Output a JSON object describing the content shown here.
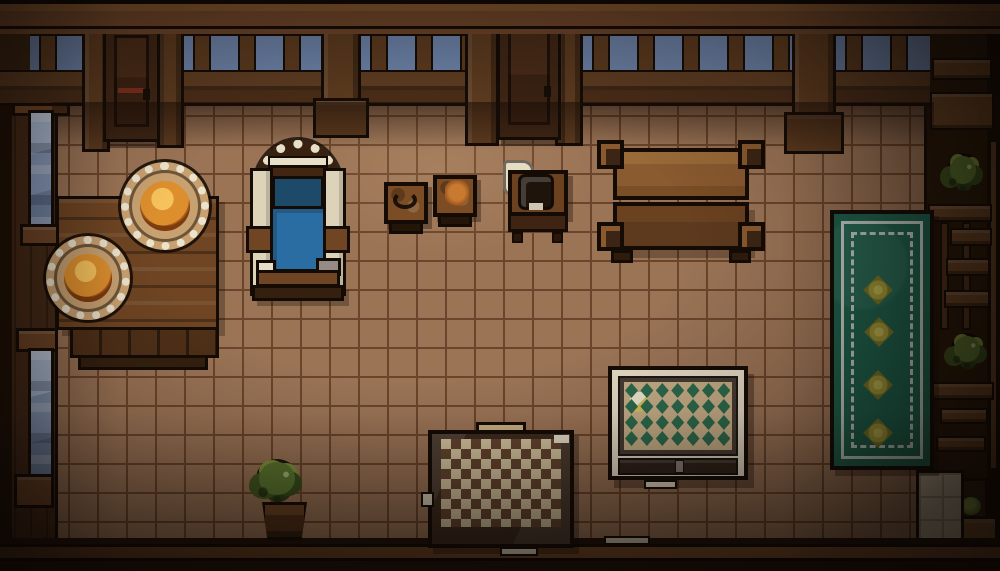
{
  "scene": {
    "title": "Top-down pixel-art tavern room",
    "style": "16-bit interior, warm lighting, dark vignette"
  },
  "palette": {
    "outline": "#140b05",
    "floor": "#9b7456",
    "floorGrout": "#6b452b",
    "wallDark": "#3a2412",
    "beam": "#70472a",
    "beamLight": "#83552e",
    "sky": "#6e85ac",
    "railLight": "#5f3d22",
    "railDark": "#4a2d18",
    "post": "#5d3b1f",
    "door": "#3f2615",
    "leftWall": "#452a17",
    "window": "#8b9fc0",
    "windowLight": "#aebfd8",
    "sill": "#6f4526",
    "rightWall": "#281808",
    "shelfWood": "#6b4423",
    "lightTiles": "#cfc2a8",
    "lightTileGrout": "#a89a82",
    "tableWood": "#6f4523",
    "tableWoodDark": "#4f3018",
    "plate": "#ece3cd",
    "plateInner": "#c8a171",
    "food": "#dd8f2e",
    "foodLight": "#f5c25c",
    "foodDark": "#a85a18",
    "bedCream": "#ddd3b8",
    "bedWhite": "#e8dfc9",
    "bedBlueDark": "#1d4a68",
    "bedBlue": "#2a6da3",
    "bedWood": "#6f4523",
    "stoolTop": "#7c4d24",
    "cloth": "#e5dcc4",
    "kettle": "#1f140c",
    "bigTableLight": "#8a5a30",
    "bigTableDark": "#5d3a1e",
    "rugGreen": "#1d6550",
    "rugWhite": "#ccd6d0",
    "flower": "#aaa23c",
    "flowerLight": "#c9bd55",
    "flowerDark": "#7f7c26",
    "diamondTan": "#c9b089",
    "diamondGreen": "#2c6b4e",
    "diamondFrame": "#463c34",
    "diamondBorder": "#e6ddc8",
    "checkerCream": "#d8c7a2",
    "checkerBrown": "#64452e",
    "checkerFrame": "#3c2b1e",
    "bushGreen": "#5d7a30",
    "bushLight": "#81973e",
    "bushDark": "#31461b"
  },
  "rugs": {
    "runner": {
      "flower_count": 4,
      "flowers": [
        {
          "x": 46,
          "y": 30
        },
        {
          "x": 47,
          "y": 47
        },
        {
          "x": 46,
          "y": 68
        },
        {
          "x": 46,
          "y": 87
        }
      ]
    },
    "diamond": {
      "rows": 4,
      "cols": 7
    }
  },
  "entities": [
    {
      "id": "door-top-left",
      "label": "Wooden door"
    },
    {
      "id": "door-top-center",
      "label": "Wooden door"
    },
    {
      "id": "dining-table",
      "label": "Table with two plates of food"
    },
    {
      "id": "armchair",
      "label": "Blue armchair"
    },
    {
      "id": "stool-left",
      "label": "Stool with dark bowl"
    },
    {
      "id": "stool-right",
      "label": "Stool with food"
    },
    {
      "id": "nightstand",
      "label": "Nightstand with kettle and cloth"
    },
    {
      "id": "large-table",
      "label": "Large wooden table"
    },
    {
      "id": "runner-rug",
      "label": "Green runner rug with flowers"
    },
    {
      "id": "diamond-rug",
      "label": "Diamond-pattern rug"
    },
    {
      "id": "checker-rug",
      "label": "Checkered rug"
    },
    {
      "id": "potted-bush",
      "label": "Potted bush"
    },
    {
      "id": "shelf-plant-upper",
      "label": "Shelf plant"
    },
    {
      "id": "shelf-plant-lower",
      "label": "Shelf plant"
    },
    {
      "id": "corner-plant",
      "label": "Small potted plant"
    }
  ]
}
